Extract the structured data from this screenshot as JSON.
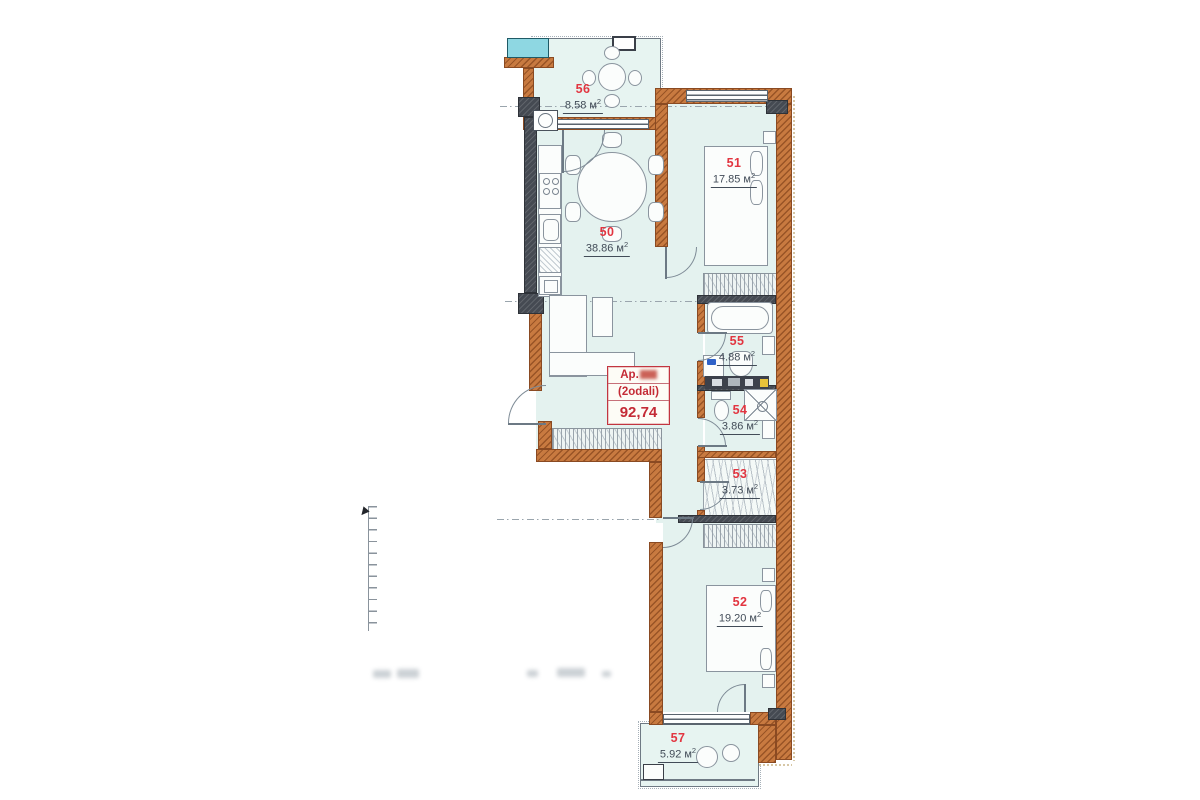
{
  "info_box": {
    "prefix": "Ap.",
    "unit_type": "(2odali)",
    "total_area": "92,74"
  },
  "rooms": [
    {
      "number": "56",
      "area": "8.58 м",
      "sup": "2"
    },
    {
      "number": "50",
      "area": "38.86 м",
      "sup": "2"
    },
    {
      "number": "51",
      "area": "17.85 м",
      "sup": "2"
    },
    {
      "number": "55",
      "area": "4.88 м",
      "sup": "2"
    },
    {
      "number": "54",
      "area": "3.86 м",
      "sup": "2"
    },
    {
      "number": "53",
      "area": "3.73 м",
      "sup": "2"
    },
    {
      "number": "52",
      "area": "19.20 м",
      "sup": "2"
    },
    {
      "number": "57",
      "area": "5.92 м",
      "sup": "2"
    }
  ],
  "colors": {
    "wall_orange": "#c87a40",
    "wall_dark": "#454a52",
    "room_fill": "#e4f2ef",
    "accent_red": "#e23540",
    "info_red": "#c42b36",
    "teal_unit": "#8ed7e2"
  }
}
